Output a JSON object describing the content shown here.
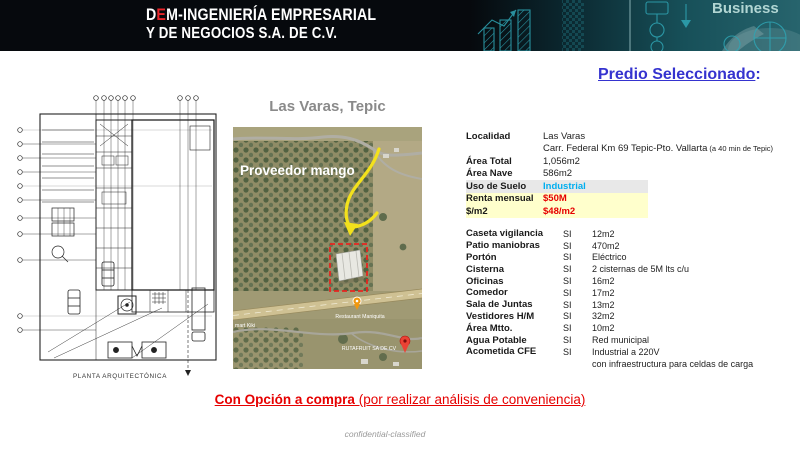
{
  "header": {
    "logo": {
      "d": "D",
      "e": "E",
      "rest": "M-INGENIERÍA EMPRESARIAL",
      "line2": "Y DE NEGOCIOS S.A. DE C.V."
    },
    "art_text": "Business"
  },
  "title": {
    "text": "Predio Seleccionado",
    "colon": ":"
  },
  "plan": {
    "caption": "PLANTA ARQUITECTÓNICA"
  },
  "map": {
    "title": "Las Varas, Tepic",
    "overlay": "Proveedor mango",
    "poi_restaurant": "Restaurant Maniquita",
    "poi_company": "RUTAFRUIT SA DE CV",
    "poi_store": "mart Kiki"
  },
  "details": {
    "rows1": [
      {
        "label": "Localidad",
        "value": "Las Varas"
      },
      {
        "label": "",
        "value": "Carr. Federal Km 69 Tepic-Pto. Vallarta",
        "note": "(a 40 min de Tepic)"
      },
      {
        "label": "Área Total",
        "value": "1,056m2"
      },
      {
        "label": "Área Nave",
        "value": "586m2"
      },
      {
        "label": "Uso de Suelo",
        "value": "Industrial"
      },
      {
        "label": "Renta mensual",
        "value": "$50M"
      },
      {
        "label": "$/m2",
        "value": "$48/m2"
      }
    ],
    "rows2": [
      {
        "label": "Caseta vigilancia",
        "flag": "SI",
        "value": "12m2"
      },
      {
        "label": "Patio maniobras",
        "flag": "SI",
        "value": "470m2"
      },
      {
        "label": "Portón",
        "flag": "SI",
        "value": "Eléctrico"
      },
      {
        "label": "Cisterna",
        "flag": "SI",
        "value": "2 cisternas de 5M lts c/u"
      },
      {
        "label": "Oficinas",
        "flag": "SI",
        "value": "16m2"
      },
      {
        "label": "Comedor",
        "flag": "SI",
        "value": "17m2"
      },
      {
        "label": "Sala de Juntas",
        "flag": "SI",
        "value": "13m2"
      },
      {
        "label": "Vestidores H/M",
        "flag": "SI",
        "value": "32m2"
      },
      {
        "label": "Área Mtto.",
        "flag": "SI",
        "value": "10m2"
      },
      {
        "label": "Agua Potable",
        "flag": "SI",
        "value": "Red municipal"
      },
      {
        "label": "Acometida CFE",
        "flag": "SI",
        "value": "Industrial a 220V"
      },
      {
        "label": "",
        "flag": "",
        "value": "con infraestructura para celdas de carga"
      }
    ]
  },
  "footer": {
    "option_bold": "Con Opción a compra",
    "option_rest": " (por realizar análisis de conveniencia)",
    "confidential": "confidential-classified"
  },
  "colors": {
    "header_bg": "#06090d",
    "sketch_teal": "#2fa5b4",
    "title_blue": "#3533cf",
    "alert_red": "#e60000",
    "industrial_cyan": "#00aeef",
    "highlight_yellow": "#ffffcc",
    "highlight_gray": "#e8e8e8",
    "logo_red": "#e8252a",
    "map_arrow_yellow": "#f3e11c",
    "map_box_red": "#e8251f"
  }
}
